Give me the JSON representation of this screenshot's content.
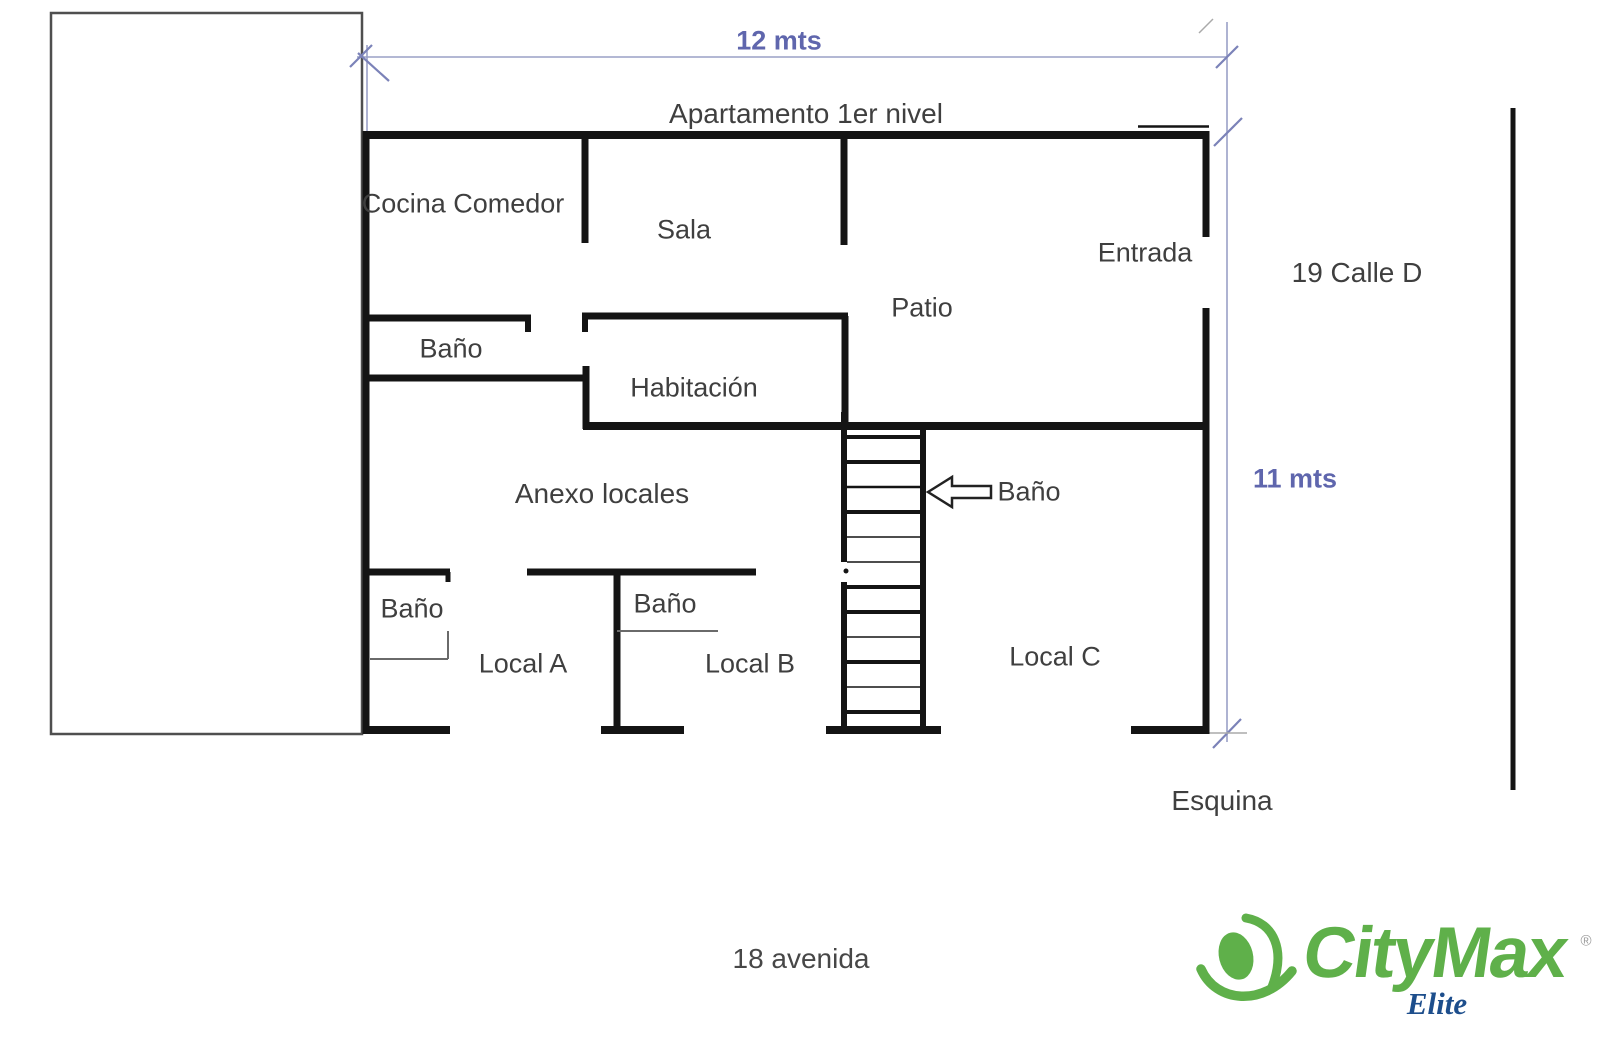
{
  "floor_plan": {
    "title": "Apartamento 1er nivel",
    "rooms": {
      "cocina_comedor": "Cocina Comedor",
      "sala": "Sala",
      "entrada": "Entrada",
      "patio": "Patio",
      "bano_apartamento": "Baño",
      "habitacion": "Habitación",
      "anexo_locales": "Anexo locales",
      "bano_escaleras": "Baño",
      "bano_local_a": "Baño",
      "bano_local_b": "Baño",
      "local_a": "Local A",
      "local_b": "Local B",
      "local_c": "Local C"
    },
    "dimensions": {
      "ancho": "12 mts",
      "alto": "11 mts"
    },
    "surroundings": {
      "calle": "19 Calle D",
      "esquina": "Esquina",
      "avenida": "18 avenida"
    }
  },
  "logo": {
    "brand": "CityMax",
    "registered": "®",
    "tagline": "Elite"
  },
  "colors": {
    "wall": "#141414",
    "dimension_text": "#5f66ad",
    "dimension_line": "#9aa0c6",
    "label_text": "#3f3f3f",
    "logo_green": "#5fb04a",
    "logo_navy": "#1d4e8c"
  }
}
